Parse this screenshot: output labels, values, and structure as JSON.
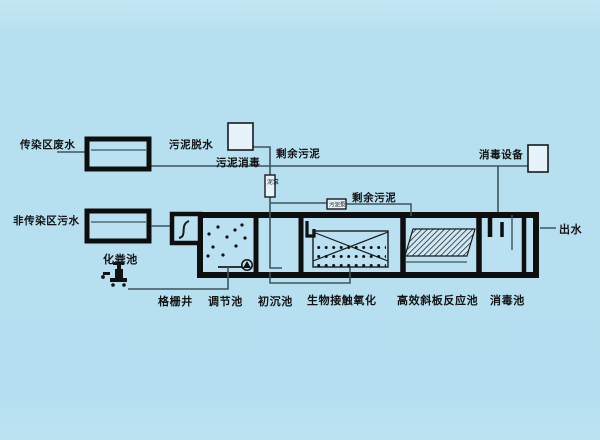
{
  "diagram": {
    "kind": "wastewater-treatment-process-flow",
    "labels": {
      "infectious_wastewater": "传染区废水",
      "non_infectious_wastewater": "非传染区污水",
      "sludge_dewatering": "污泥脱水",
      "sludge_disinfection": "污泥消毒",
      "excess_sludge_upper": "剩余污泥",
      "excess_sludge_lower": "剩余污泥",
      "disinfection_equipment": "消毒设备",
      "effluent": "出水",
      "septic_tank": "化粪池",
      "screen_well": "格栅井",
      "regulating_tank": "调节池",
      "primary_sedimentation_tank": "初沉池",
      "bio_contact_oxidation_tank": "生物接触氧化",
      "inclined_plate_reactor_tank": "高效斜板反应池",
      "disinfection_tank": "消毒池",
      "sludge_pump_vertical": "泥泵",
      "sludge_pump_horizontal": "污泥泵"
    },
    "colors": {
      "background": "#b5dff0",
      "tank_wall": "#0e0e0e",
      "pipe_line": "#3f545e",
      "equipment_fill": "#e6f3fa",
      "text": "#141414"
    }
  }
}
